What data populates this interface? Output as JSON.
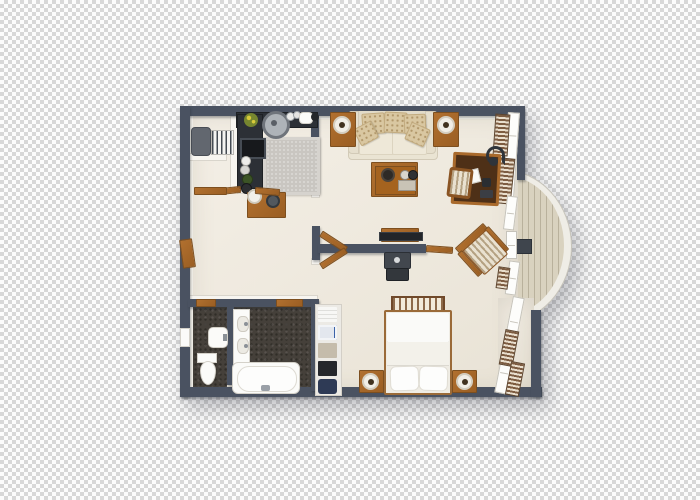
{
  "scene": {
    "description": "3D top-down architectural render of a one-bedroom apartment floor plan with a curved balcony, shown over a transparency checkerboard background",
    "background": "transparency-checkerboard",
    "visible_text": "none"
  },
  "colors": {
    "checkerLight": "#fcfcfc",
    "checkerDark": "#d8d8d8",
    "wallDark": "#4a5261",
    "wallWhite": "#f7f5f0",
    "wallWhiteEdge": "#d9d5cc",
    "floorCream": "#e9e3d6",
    "floorLight": "#f4efe6",
    "counterDark": "#2c3036",
    "rugGray": "#c9c6c1",
    "bathFloor": "#45403a",
    "wood": "#b1702f",
    "woodDark": "#7d4f1f",
    "sofaCream": "#eae4d3",
    "cushionBeige": "#d9c7a1",
    "cushionDot": "#b1976a",
    "fixtureWhite": "#fbfbf9",
    "deck": "#d9d2bf",
    "deckLine": "#b9b19c",
    "curtainBrown": "#7d5c41",
    "curtainLight": "#e9decd",
    "tvBlack": "#222529",
    "metal": "#3f454d"
  },
  "rooms": [
    {
      "name": "kitchen",
      "furniture": [
        "l-shaped-dark-counter",
        "cooktop",
        "round-sink",
        "potted-plant",
        "kettle",
        "jars",
        "gray-rug"
      ]
    },
    {
      "name": "entry-nook",
      "furniture": [
        "luggage",
        "radiator"
      ]
    },
    {
      "name": "hallway",
      "furniture": [
        "console-table",
        "serving-plate",
        "bowl"
      ]
    },
    {
      "name": "living-room",
      "furniture": [
        "cream-sofa",
        "patterned-cushions",
        "side-table-left",
        "side-table-right",
        "table-lamps",
        "coffee-table",
        "writing-desk",
        "desk-lamp",
        "desk-chair",
        "tv-console",
        "tv",
        "av-cabinet"
      ]
    },
    {
      "name": "bedroom",
      "furniture": [
        "double-bed",
        "foot-bench",
        "pillows",
        "nightstand-left",
        "nightstand-right",
        "bedside-lamps",
        "linen-shelf",
        "striped-armchair"
      ]
    },
    {
      "name": "bathroom",
      "furniture": [
        "vanity-counter",
        "wall-basin",
        "towel-shelf",
        "toilet",
        "bathtub"
      ]
    },
    {
      "name": "balcony",
      "furniture": [
        "curved-plank-deck",
        "curved-railing",
        "balcony-door"
      ]
    }
  ],
  "architecture": [
    "dark-slate-exterior-walls",
    "white-interior-partitions",
    "open-wood-door-panels",
    "window-wall-with-louvered-curtains",
    "semicircular-bay-balcony"
  ]
}
